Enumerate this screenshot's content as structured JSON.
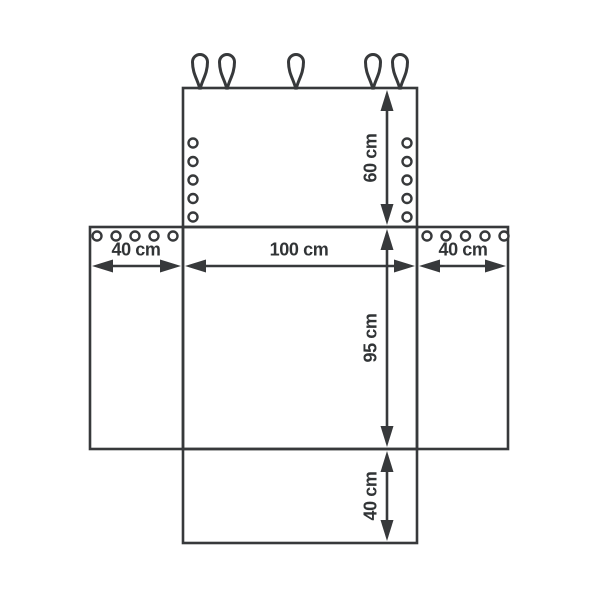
{
  "page": {
    "background_color": "#ffffff"
  },
  "diagram": {
    "kind": "dimensioned-pattern-drawing",
    "description": "Cross-shaped flat pattern (cover/blanket) with hanging loops, eyelets and dimension arrows",
    "unit": "cm",
    "line_color": "#37393b",
    "fill_color": "#ffffff",
    "labels": {
      "top_height": "60 cm",
      "center_width": "100 cm",
      "left_flap_width": "40 cm",
      "right_flap_width": "40 cm",
      "center_height": "95 cm",
      "bottom_height": "40 cm"
    },
    "values": {
      "top_height_cm": 60,
      "center_width_cm": 100,
      "left_flap_width_cm": 40,
      "right_flap_width_cm": 40,
      "center_height_cm": 95,
      "bottom_height_cm": 40
    },
    "loops": {
      "count": 5,
      "grouping": "pair-left, single-center, pair-right"
    },
    "eyelets": {
      "top_panel_left_column": 5,
      "top_panel_right_column": 5,
      "left_flap_top_row": 5,
      "right_flap_top_row": 5
    }
  }
}
